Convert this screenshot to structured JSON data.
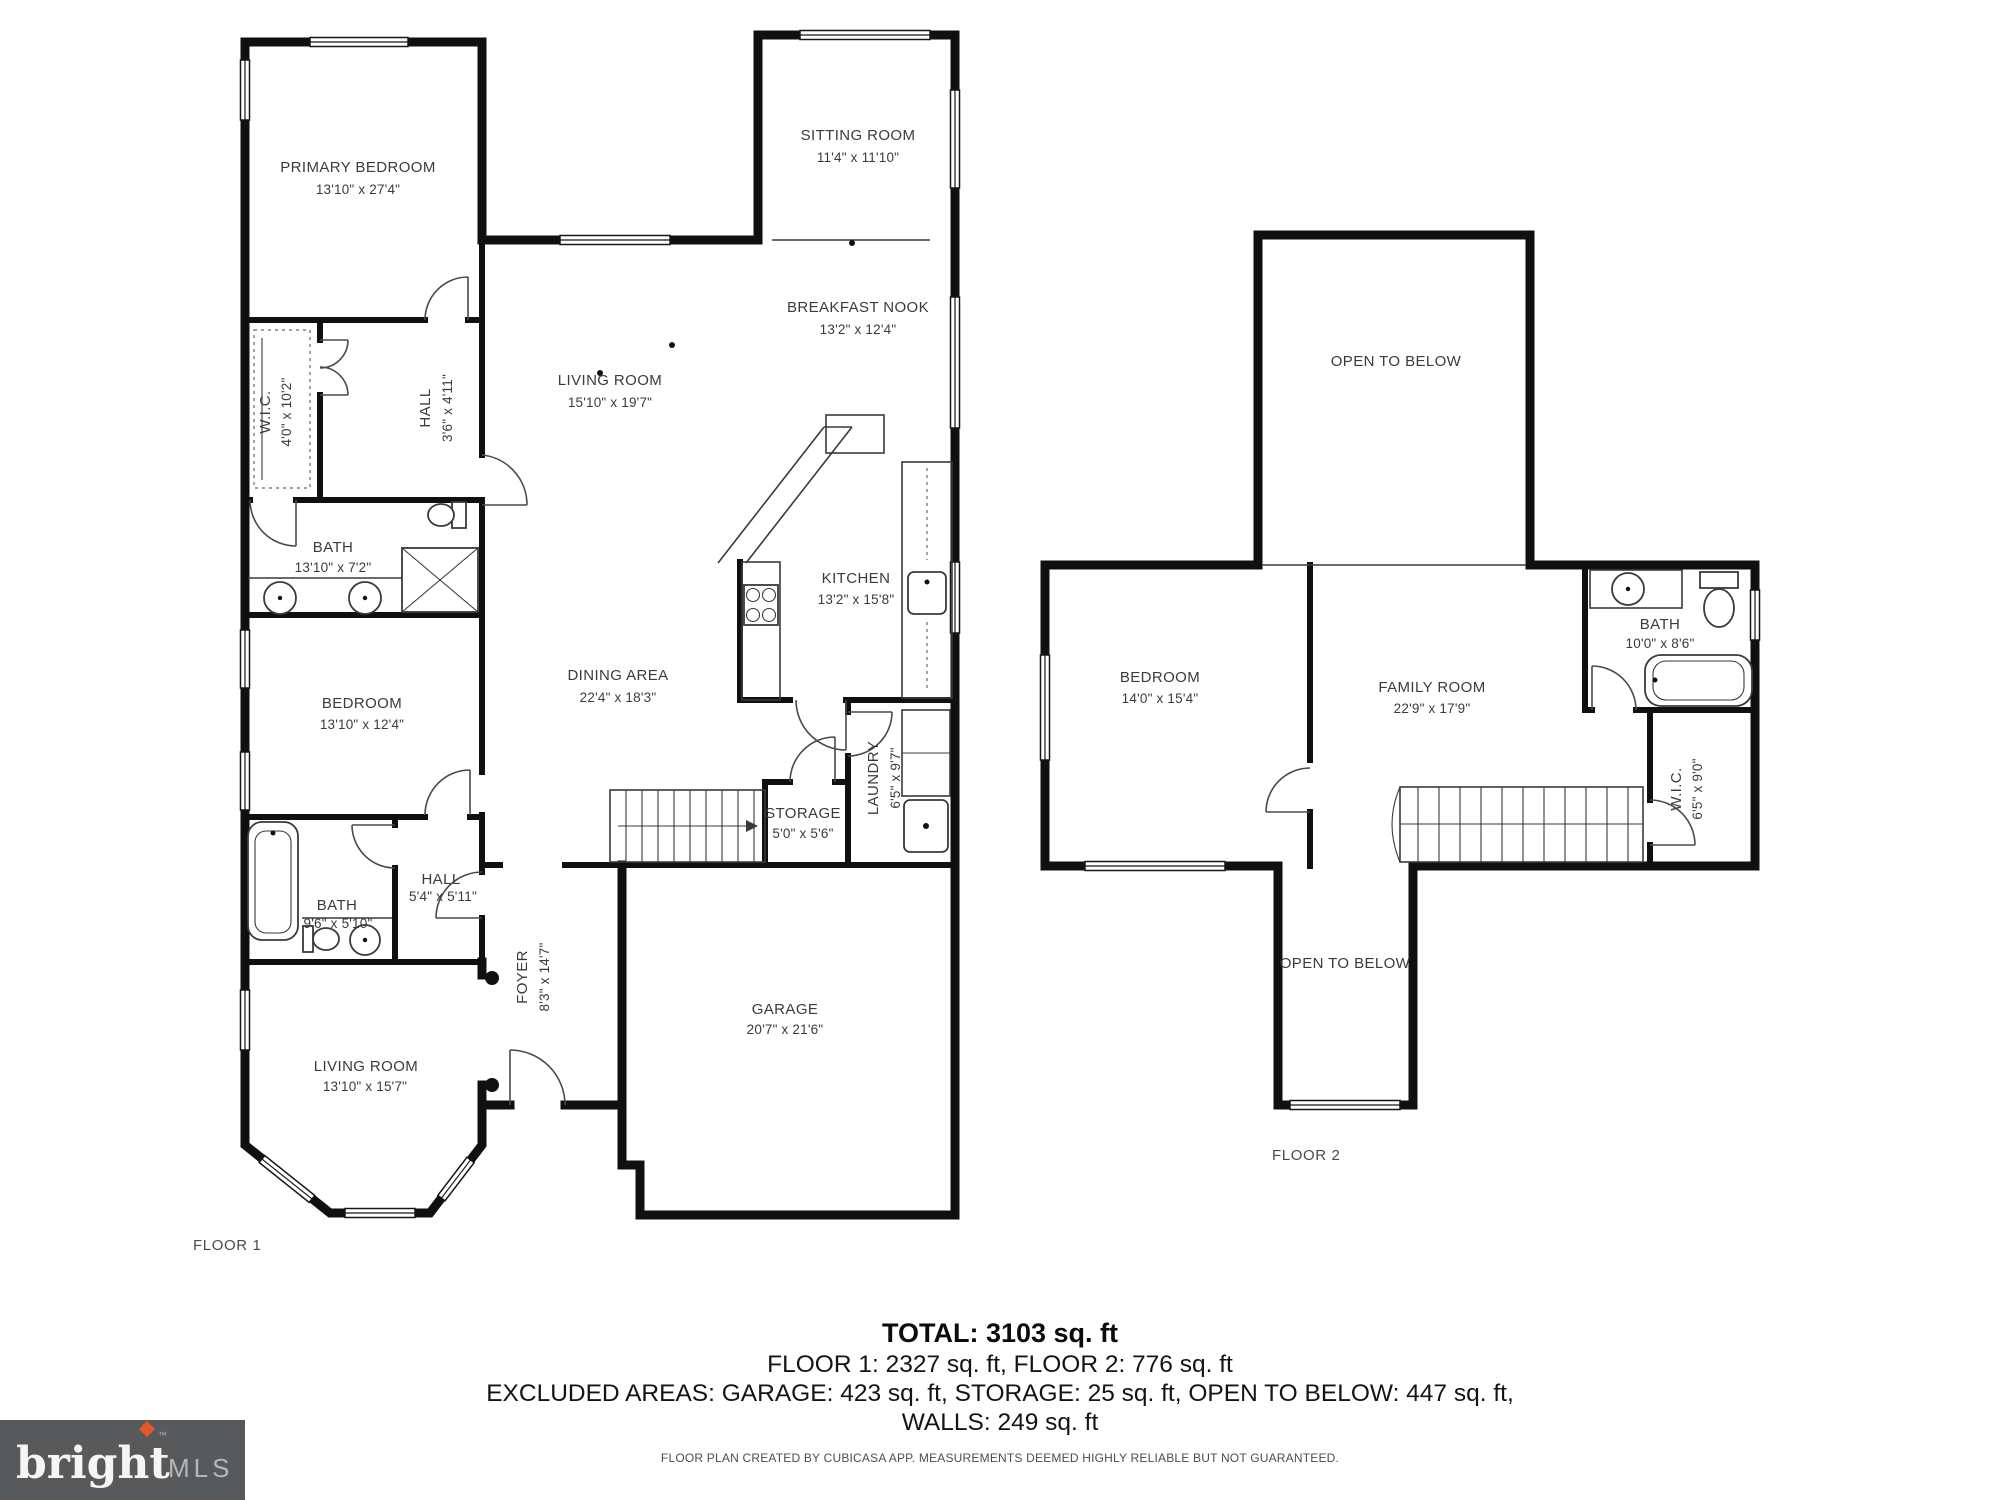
{
  "colors": {
    "wall": "#101010",
    "label_text": "#3b3b3b",
    "logo_bg": "#58595b",
    "logo_accent": "#e2562b",
    "logo_mls": "#b4b6b8"
  },
  "floor1": {
    "label": "FLOOR 1",
    "rooms": {
      "primary_bedroom": {
        "name": "PRIMARY BEDROOM",
        "dims": "13'10\" x 27'4\""
      },
      "sitting_room": {
        "name": "SITTING ROOM",
        "dims": "11'4\" x 11'10\""
      },
      "breakfast_nook": {
        "name": "BREAKFAST NOOK",
        "dims": "13'2\" x 12'4\""
      },
      "living_room": {
        "name": "LIVING ROOM",
        "dims": "15'10\" x 19'7\""
      },
      "wic": {
        "name": "W.I.C.",
        "dims": "4'0\" x 10'2\""
      },
      "hall_upper": {
        "name": "HALL",
        "dims": "3'6\" x 4'11\""
      },
      "bath_primary": {
        "name": "BATH",
        "dims": "13'10\" x 7'2\""
      },
      "kitchen": {
        "name": "KITCHEN",
        "dims": "13'2\" x 15'8\""
      },
      "dining_area": {
        "name": "DINING AREA",
        "dims": "22'4\" x 18'3\""
      },
      "bedroom": {
        "name": "BEDROOM",
        "dims": "13'10\" x 12'4\""
      },
      "laundry": {
        "name": "LAUNDRY",
        "dims": "6'5\" x 9'7\""
      },
      "storage": {
        "name": "STORAGE",
        "dims": "5'0\" x 5'6\""
      },
      "hall_lower": {
        "name": "HALL",
        "dims": "5'4\" x 5'11\""
      },
      "bath_lower": {
        "name": "BATH",
        "dims": "9'6\" x 5'10\""
      },
      "foyer": {
        "name": "FOYER",
        "dims": "8'3\" x 14'7\""
      },
      "living_room_front": {
        "name": "LIVING ROOM",
        "dims": "13'10\" x 15'7\""
      },
      "garage": {
        "name": "GARAGE",
        "dims": "20'7\" x 21'6\""
      }
    }
  },
  "floor2": {
    "label": "FLOOR 2",
    "rooms": {
      "open_to_below_top": {
        "name": "OPEN TO BELOW"
      },
      "bedroom": {
        "name": "BEDROOM",
        "dims": "14'0\" x 15'4\""
      },
      "family_room": {
        "name": "FAMILY ROOM",
        "dims": "22'9\" x 17'9\""
      },
      "bath": {
        "name": "BATH",
        "dims": "10'0\" x 8'6\""
      },
      "wic": {
        "name": "W.I.C.",
        "dims": "6'5\" x 9'0\""
      },
      "open_to_below_bottom": {
        "name": "OPEN TO BELOW"
      }
    }
  },
  "summary": {
    "total": "TOTAL: 3103 sq. ft",
    "floors": "FLOOR 1: 2327 sq. ft, FLOOR 2: 776 sq. ft",
    "excluded": "EXCLUDED AREAS: GARAGE: 423 sq. ft, STORAGE: 25 sq. ft, OPEN TO BELOW: 447 sq. ft,",
    "walls": "WALLS: 249 sq. ft",
    "disclaimer": "FLOOR PLAN CREATED BY CUBICASA APP. MEASUREMENTS DEEMED HIGHLY RELIABLE BUT NOT GUARANTEED."
  },
  "logo": {
    "brand": "bright",
    "tm": "™",
    "suffix": "MLS"
  }
}
